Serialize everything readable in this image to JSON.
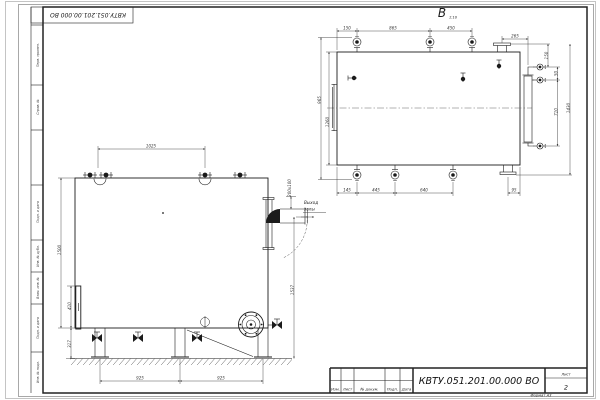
{
  "colors": {
    "paper": "#ffffff",
    "line": "#1b1b1b",
    "dim": "#3d3d3d"
  },
  "frame": {
    "stamp": "КВТУ.051.201.00.000 ВО",
    "margin_cells": [
      "Перв. примен.",
      "Справ. №",
      "Подп. и дата",
      "Инв. № дубл.",
      "Взам. инв. №",
      "Подп. и дата",
      "Инв. № подл."
    ]
  },
  "title_block": {
    "designation": "КВТУ.051.201.00.000 ВО",
    "col_labels": [
      "Изм.",
      "Лист",
      "№ докум.",
      "Подп.",
      "Дата"
    ],
    "sheet_label": "Лист",
    "sheet_number": "2",
    "format_note": "Формат А3"
  },
  "side_view": {
    "label": "В",
    "label_sub": "1:10",
    "top": [
      "150",
      "865",
      "450"
    ],
    "dim_265": "265",
    "right": [
      "150",
      "50",
      "710",
      "1430"
    ],
    "left": [
      "965",
      "1260"
    ],
    "bottom": [
      "145",
      "445",
      "640",
      "95"
    ]
  },
  "front_view": {
    "top": "1025",
    "left": [
      "1500",
      "410",
      "317"
    ],
    "bottom": [
      "925",
      "925"
    ],
    "right": "1537",
    "duct": "200х100",
    "callout_line1": "Выход",
    "callout_line2": "золы"
  }
}
